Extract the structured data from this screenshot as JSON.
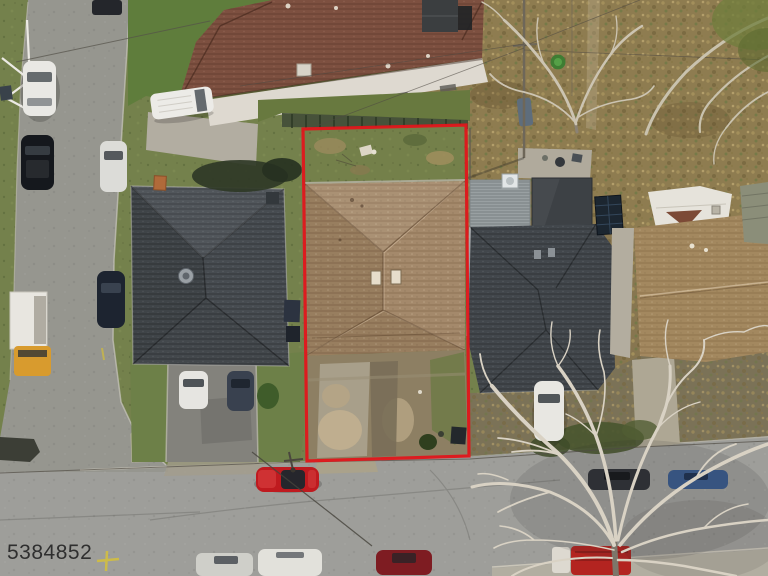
{
  "meta": {
    "description": "Aerial drone photo of a residential lot outlined in red (real-estate listing photo)",
    "width_px": 768,
    "height_px": 576
  },
  "watermark": {
    "text": "5384852",
    "color": "#262626"
  },
  "boundary": {
    "color": "#e0161b"
  },
  "scene": {
    "subject_property": {
      "roof_color": "#a18565",
      "backyard": "grass-green",
      "front_yard": "dirt-tan"
    },
    "neighbor_houses": [
      {
        "position": "top",
        "roof_color": "#7d5040",
        "wall_color": "#ded9d0"
      },
      {
        "position": "left",
        "roof_color": "#474c51"
      },
      {
        "position": "right",
        "roof_color": "#42474c"
      },
      {
        "position": "far-right",
        "roof_color": "#a3885f"
      }
    ],
    "vehicles": [
      {
        "id": "car-top-edge",
        "color": "#24262b"
      },
      {
        "id": "car-white-left-road",
        "color": "#e9e8e4"
      },
      {
        "id": "car-black-left-road",
        "color": "#15181d"
      },
      {
        "id": "car-white-roadside",
        "color": "#dcdcd8"
      },
      {
        "id": "car-darkblue-roadside",
        "color": "#1d2430"
      },
      {
        "id": "truck-yellow-flatbed",
        "color": "#d89b2e"
      },
      {
        "id": "van-white-top",
        "color": "#ecebe7"
      },
      {
        "id": "car-white-driveway",
        "color": "#e6e5e1"
      },
      {
        "id": "suv-dark-driveway",
        "color": "#39414f"
      },
      {
        "id": "car-red-street",
        "color": "#bf1a1f"
      },
      {
        "id": "car-silver-bottom",
        "color": "#cfcfc9"
      },
      {
        "id": "car-white-bottom",
        "color": "#e2e1db"
      },
      {
        "id": "car-darkred-bottom",
        "color": "#7e1c22"
      },
      {
        "id": "car-white-right-driveway",
        "color": "#e8e7e2"
      },
      {
        "id": "car-dark-under-tree",
        "color": "#2f3237"
      },
      {
        "id": "car-blue-under-tree",
        "color": "#3a5a8c"
      },
      {
        "id": "truck-red-bottom-right",
        "color": "#b32420"
      }
    ]
  }
}
